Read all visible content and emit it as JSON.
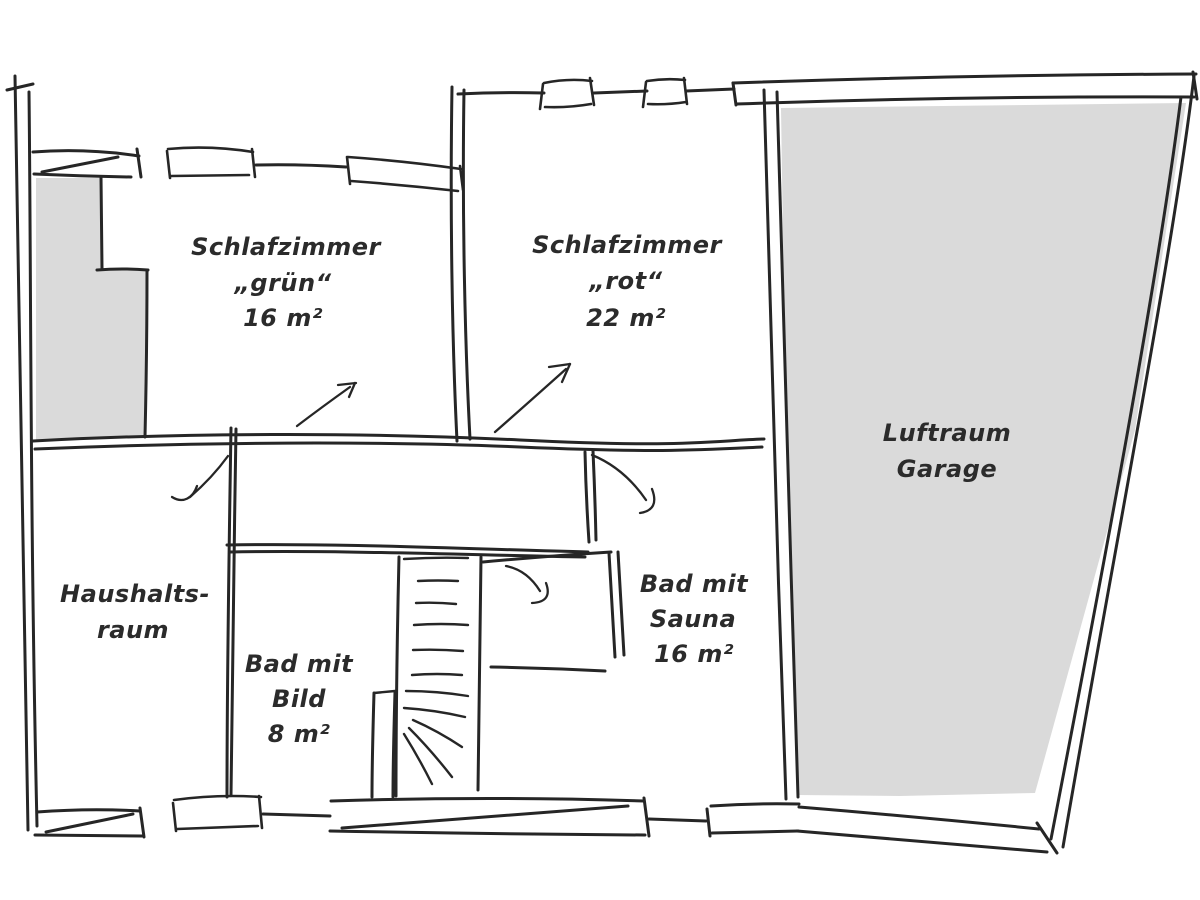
{
  "rooms": {
    "bedroom_green": {
      "line1": "Schlafzimmer",
      "line2": "„grün“",
      "line3": "16 m²"
    },
    "bedroom_red": {
      "line1": "Schlafzimmer",
      "line2": "„rot“",
      "line3": "22 m²"
    },
    "garage_void": {
      "line1": "Luftraum",
      "line2": "Garage"
    },
    "utility_room": {
      "line1": "Haushalts-",
      "line2": "raum"
    },
    "bath_picture": {
      "line1": "Bad mit",
      "line2": "Bild",
      "line3": "8 m²"
    },
    "bath_sauna": {
      "line1": "Bad mit",
      "line2": "Sauna",
      "line3": "16 m²"
    }
  },
  "colors": {
    "background": "#ffffff",
    "stroke": "#262626",
    "shaded_fill": "#dadada",
    "text": "#2b2b2b"
  }
}
